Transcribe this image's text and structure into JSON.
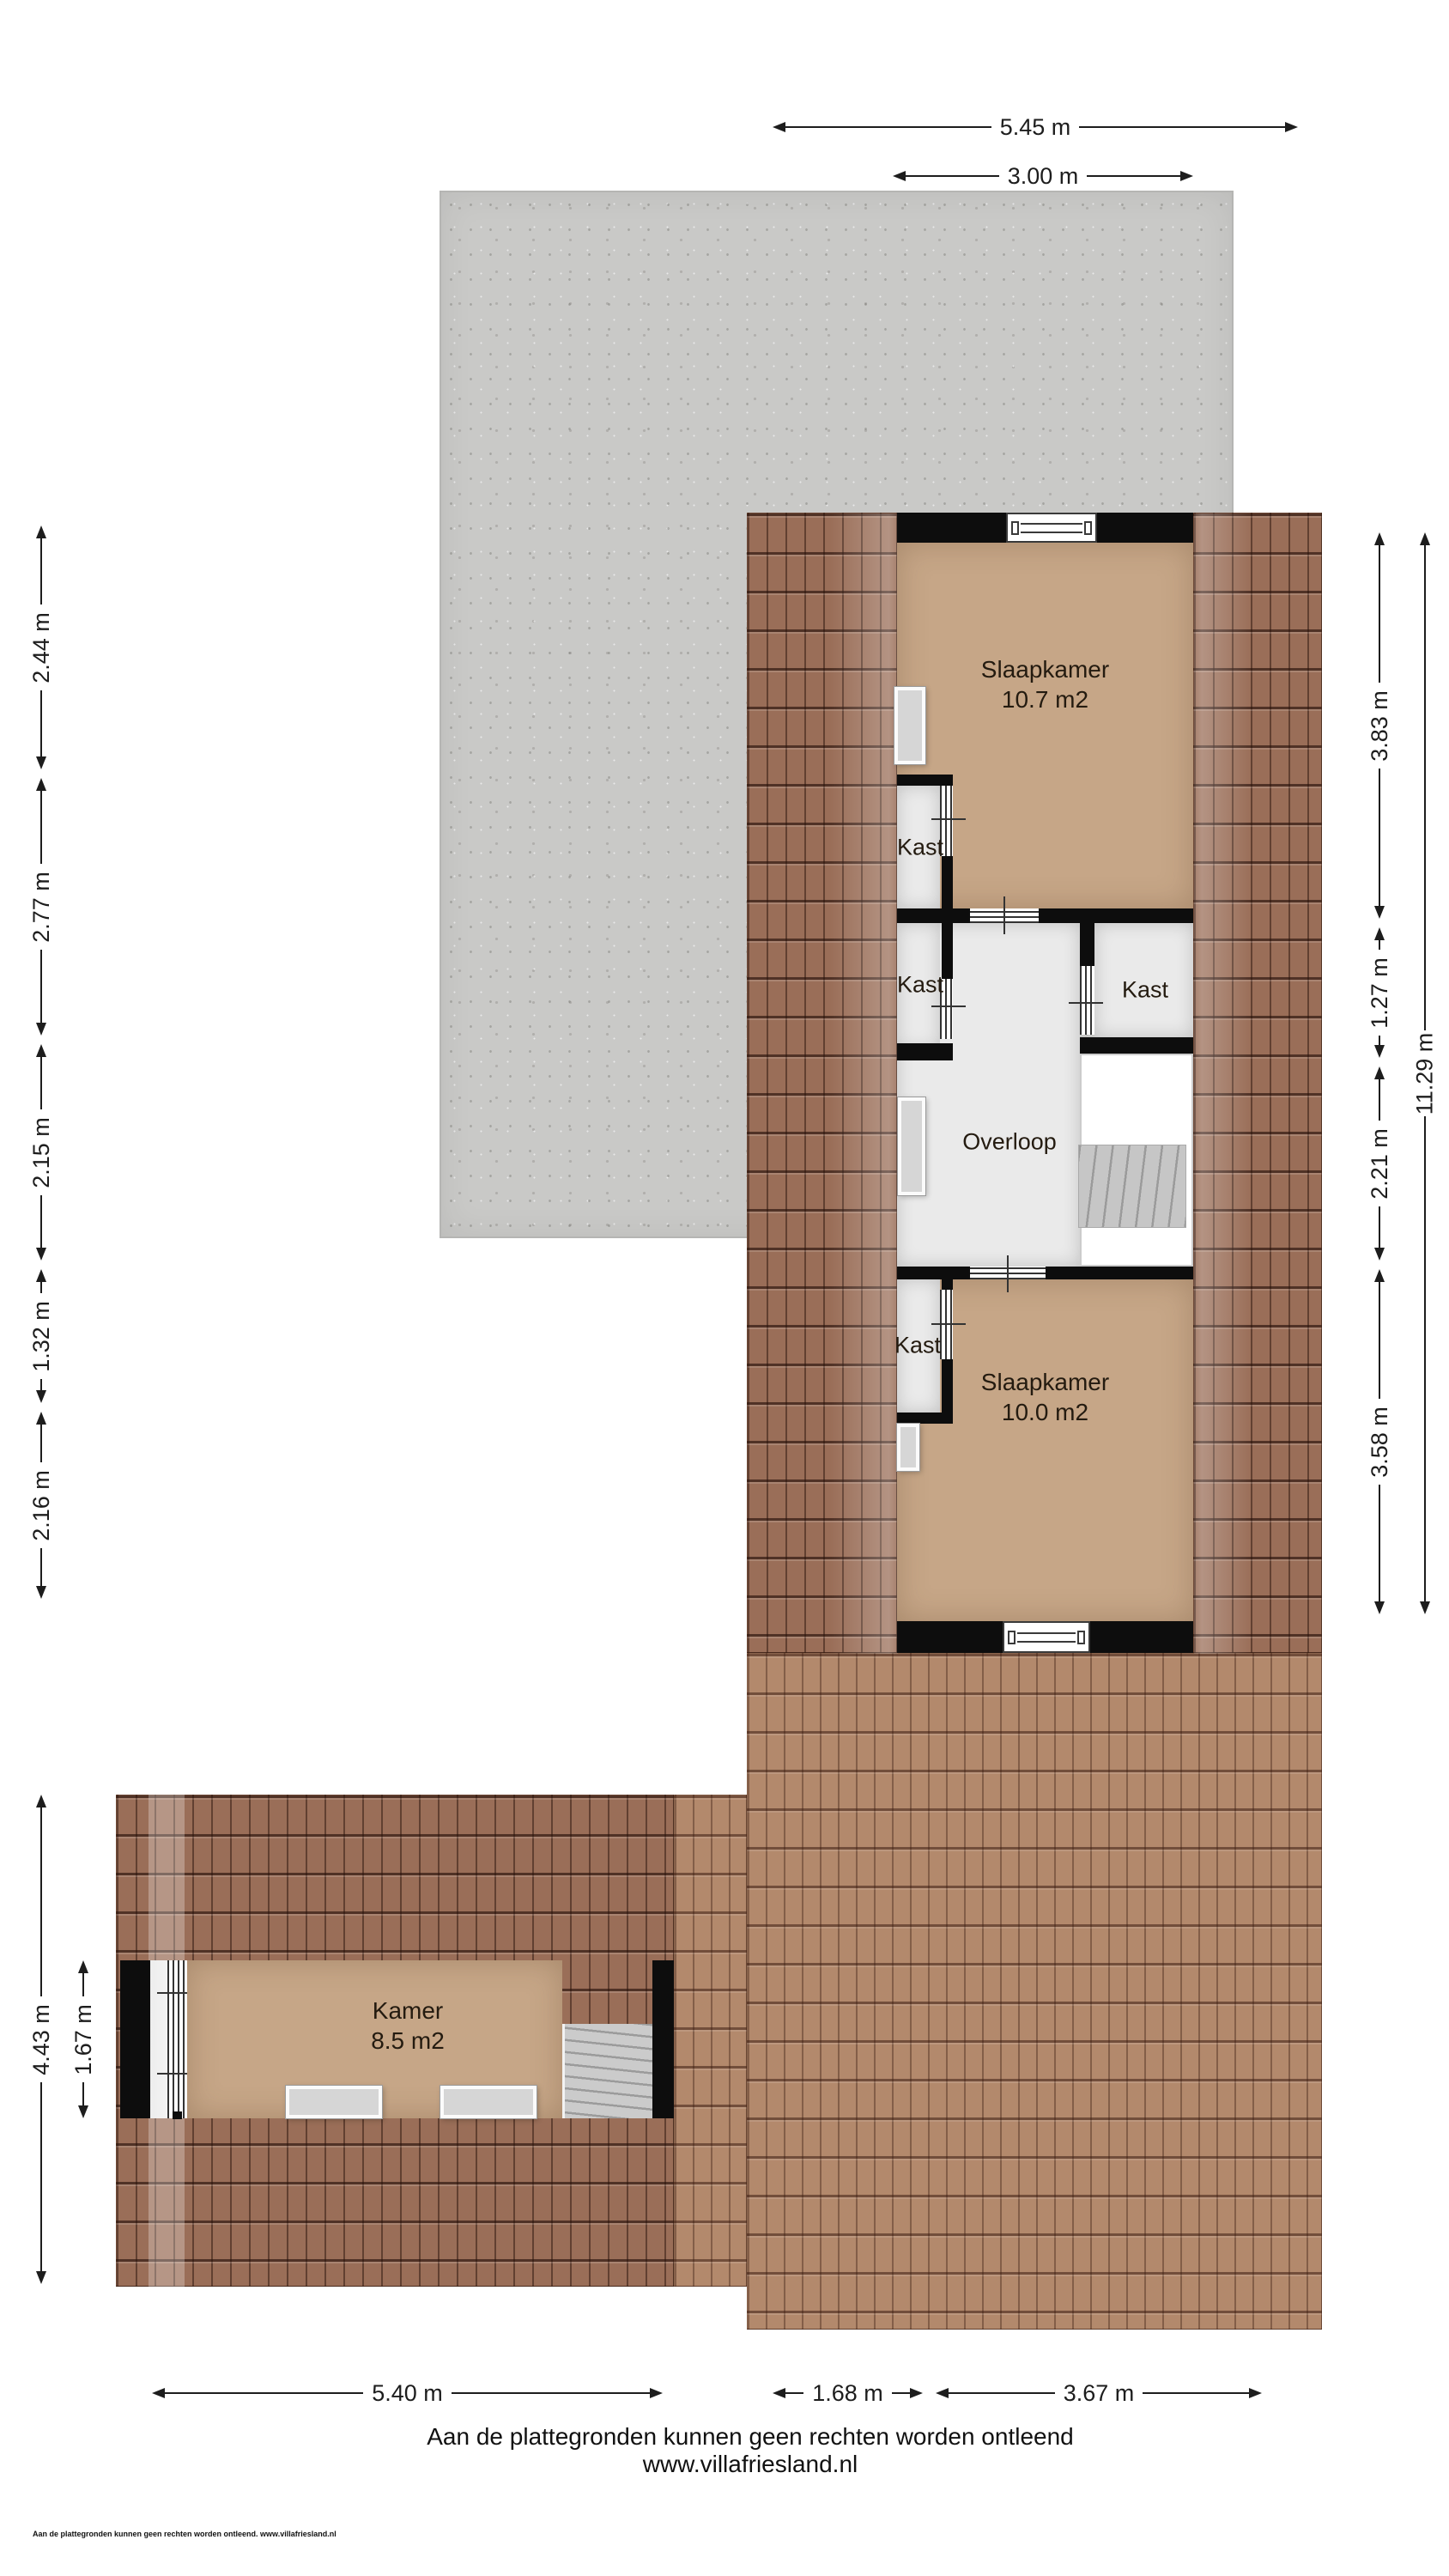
{
  "colors": {
    "floor_tan": "#c6a687",
    "closet_floor": "#eaeaea",
    "wall": "#0d0d0d",
    "roof_dark": "#9a6e58",
    "roof_light": "#b3896c",
    "concrete": "#c9c9c7"
  },
  "rooms": {
    "slaapkamer_top": {
      "name": "Slaapkamer",
      "area": "10.7 m2"
    },
    "slaapkamer_bottom": {
      "name": "Slaapkamer",
      "area": "10.0 m2"
    },
    "kamer": {
      "name": "Kamer",
      "area": "8.5 m2"
    },
    "overloop": {
      "name": "Overloop"
    },
    "kast_label": "Kast"
  },
  "dimensions": {
    "top": [
      "5.45 m",
      "3.00 m"
    ],
    "left": [
      "2.44 m",
      "2.77 m",
      "2.15 m",
      "1.32 m",
      "2.16 m"
    ],
    "right_inner": [
      "3.83 m",
      "1.27 m",
      "2.21 m",
      "3.58 m"
    ],
    "right_outer": "11.29 m",
    "bottom": [
      "5.40 m",
      "1.68 m",
      "3.67 m"
    ],
    "kamer": [
      "4.43 m",
      "1.67 m"
    ]
  },
  "footer": {
    "disclaimer": "Aan de plattegronden kunnen geen rechten worden ontleend",
    "website": "www.villafriesland.nl",
    "small_print": "Aan de plattegronden kunnen geen rechten worden ontleend. www.villafriesland.nl"
  }
}
